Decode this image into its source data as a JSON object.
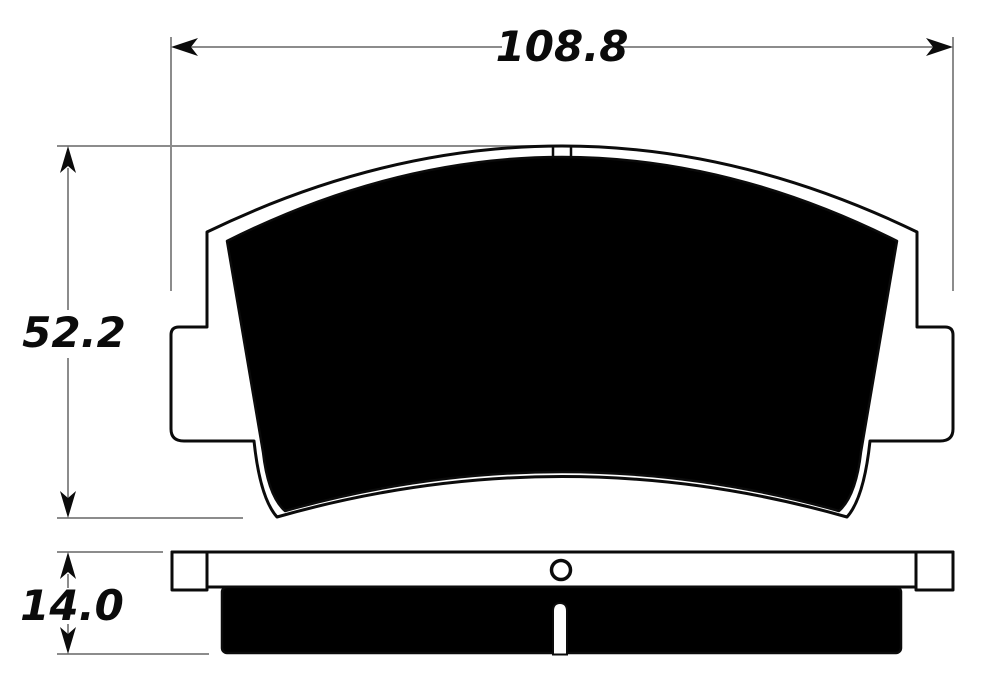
{
  "drawing": {
    "dimensions": {
      "width": {
        "label": "108.8"
      },
      "height": {
        "label": "52.2"
      },
      "thickness": {
        "label": "14.0"
      }
    },
    "colors": {
      "outline": "#0b0b0b",
      "dimension_line": "#8c8c8c",
      "label_text": "#0b0b0b",
      "background": "#ffffff",
      "friction_fill": "#000000"
    }
  }
}
